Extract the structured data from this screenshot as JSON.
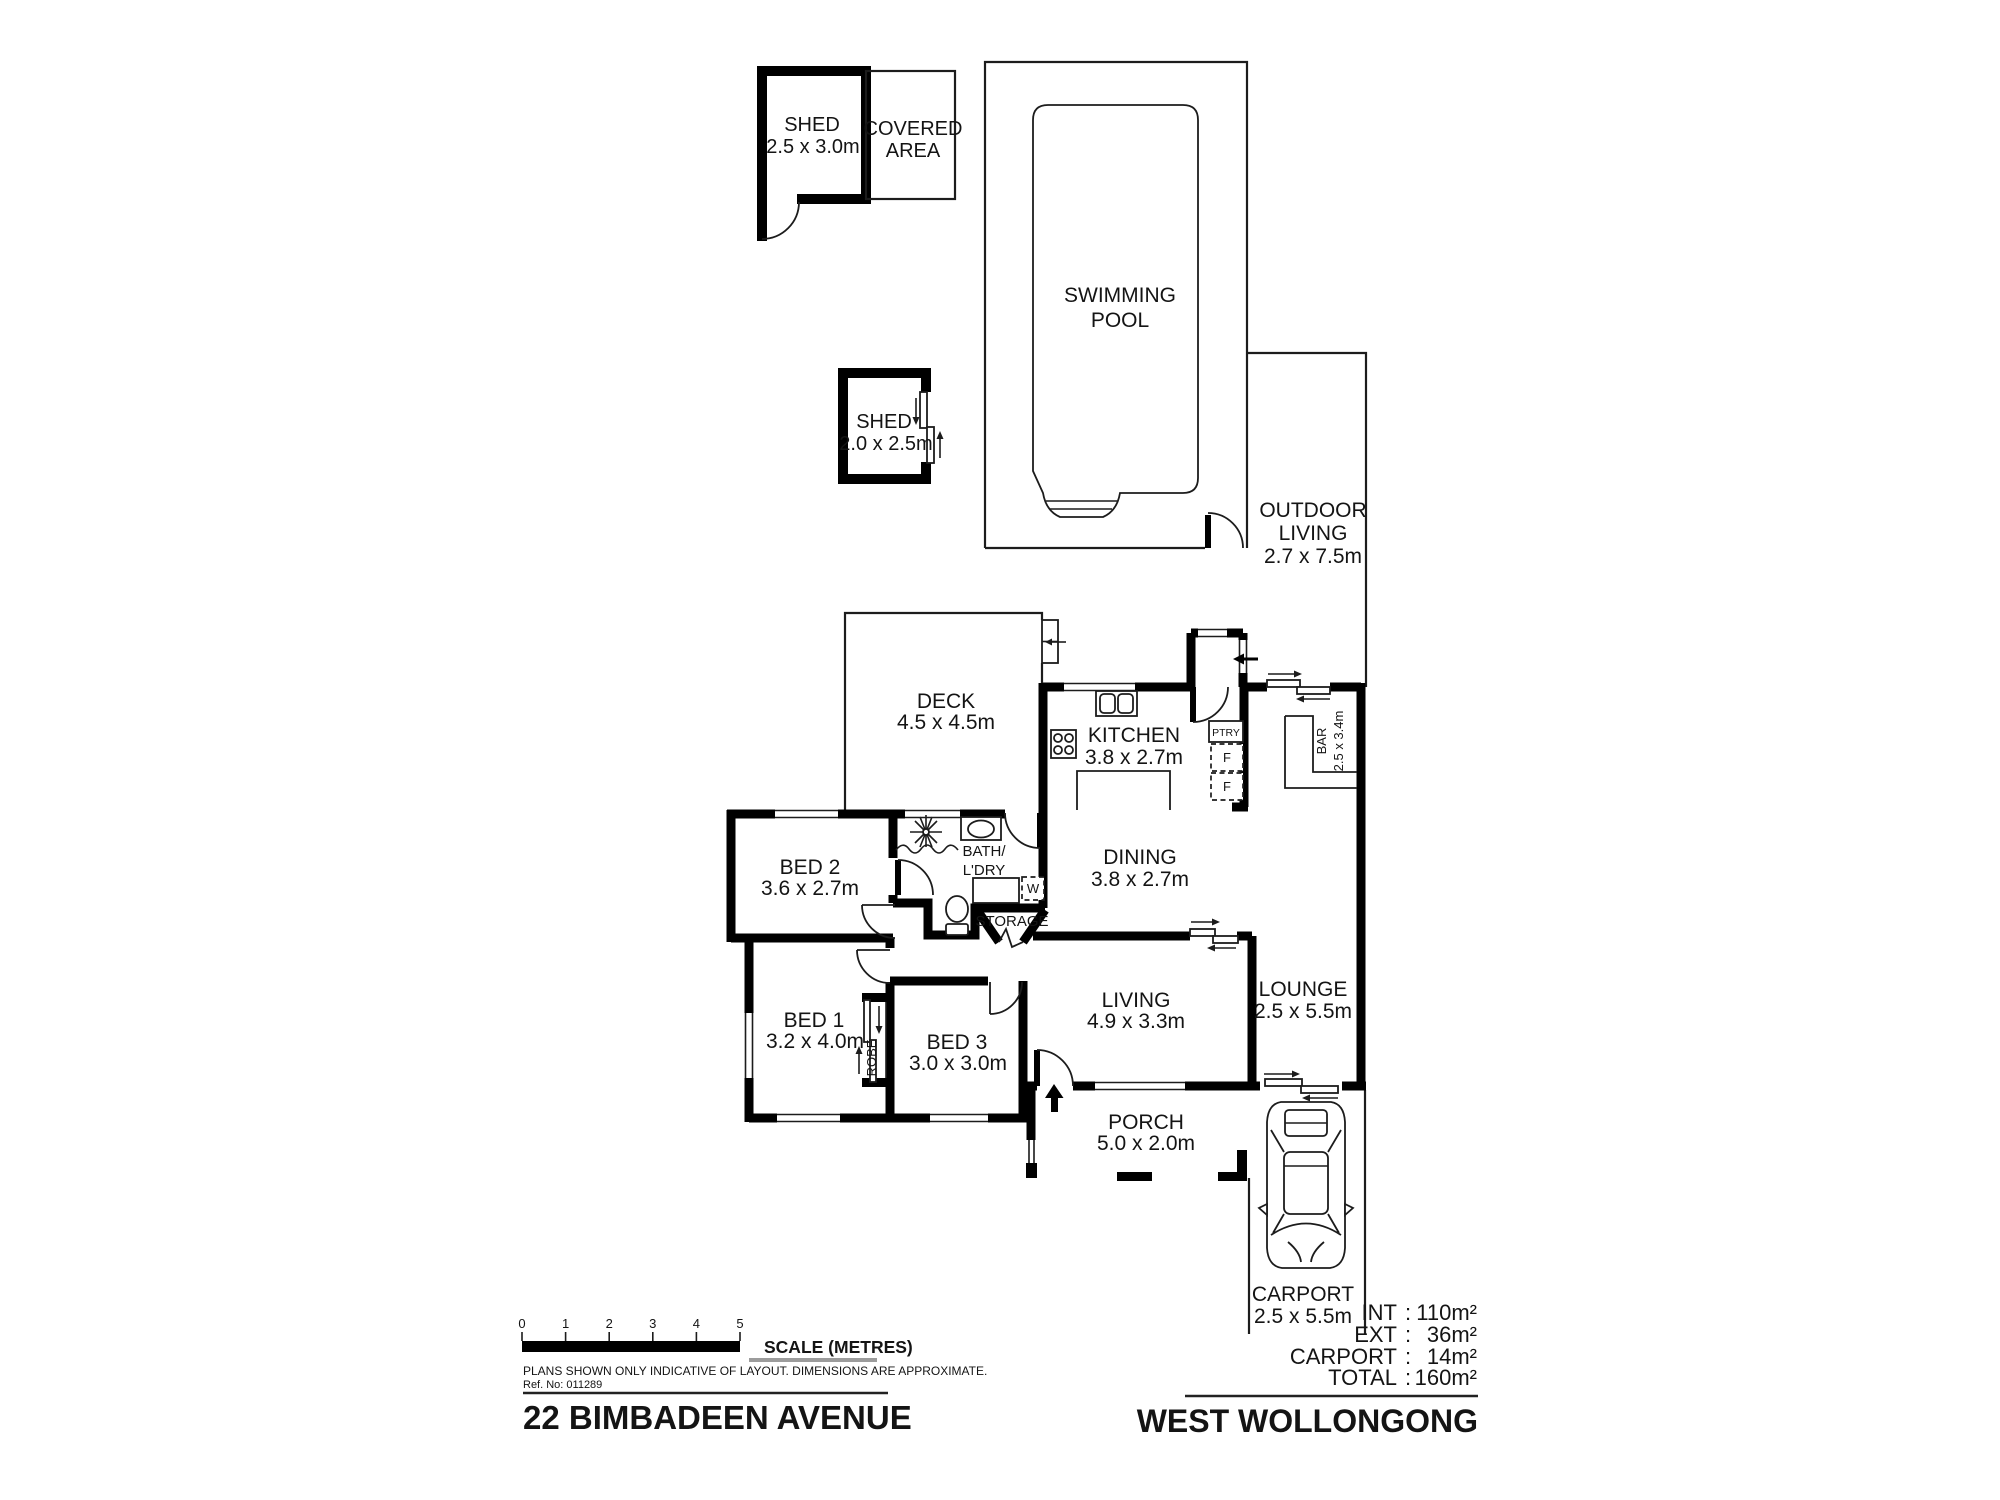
{
  "plan": {
    "site": {
      "shed1": {
        "name": "SHED",
        "dims": "2.5 x 3.0m"
      },
      "covered": {
        "line1": "COVERED",
        "line2": "AREA"
      },
      "pool": {
        "line1": "SWIMMING",
        "line2": "POOL"
      },
      "shed2": {
        "name": "SHED",
        "dims": "2.0 x 2.5m"
      },
      "outdoor": {
        "line1": "OUTDOOR",
        "line2": "LIVING",
        "dims": "2.7 x 7.5m"
      }
    },
    "rooms": {
      "deck": {
        "name": "DECK",
        "dims": "4.5 x 4.5m"
      },
      "kitchen": {
        "name": "KITCHEN",
        "dims": "3.8 x 2.7m"
      },
      "dining": {
        "name": "DINING",
        "dims": "3.8 x 2.7m"
      },
      "bar": {
        "name": "BAR",
        "dims": "2.5 x 3.4m"
      },
      "lounge": {
        "name": "LOUNGE",
        "dims": "2.5 x 5.5m"
      },
      "living": {
        "name": "LIVING",
        "dims": "4.9 x 3.3m"
      },
      "bed1": {
        "name": "BED 1",
        "dims": "3.2 x 4.0m"
      },
      "bed2": {
        "name": "BED 2",
        "dims": "3.6 x 2.7m"
      },
      "bed3": {
        "name": "BED 3",
        "dims": "3.0 x 3.0m"
      },
      "bath": {
        "line1": "BATH/",
        "line2": "L'DRY"
      },
      "storage": {
        "name": "STORAGE"
      },
      "robe": {
        "name": "ROBE"
      },
      "porch": {
        "name": "PORCH",
        "dims": "5.0 x 2.0m"
      },
      "carport": {
        "name": "CARPORT",
        "dims": "2.5 x 5.5m"
      }
    },
    "fixtures": {
      "pantry": "PTRY",
      "fridge_top": "F",
      "fridge_bottom": "F",
      "washer": "W"
    }
  },
  "areas": {
    "colon": ":",
    "rows": [
      {
        "label": "INT",
        "value": "110m²"
      },
      {
        "label": "EXT",
        "value": "36m²"
      },
      {
        "label": "CARPORT",
        "value": "14m²"
      },
      {
        "label": "TOTAL",
        "value": "160m²"
      }
    ]
  },
  "title_block": {
    "scale_ticks": [
      "0",
      "1",
      "2",
      "3",
      "4",
      "5"
    ],
    "scale_label": "SCALE (METRES)",
    "disclaimer": "PLANS SHOWN ONLY INDICATIVE OF LAYOUT.  DIMENSIONS ARE APPROXIMATE.",
    "ref_no": "Ref. No: 011289",
    "address": "22 BIMBADEEN AVENUE",
    "suburb": "WEST WOLLONGONG"
  }
}
